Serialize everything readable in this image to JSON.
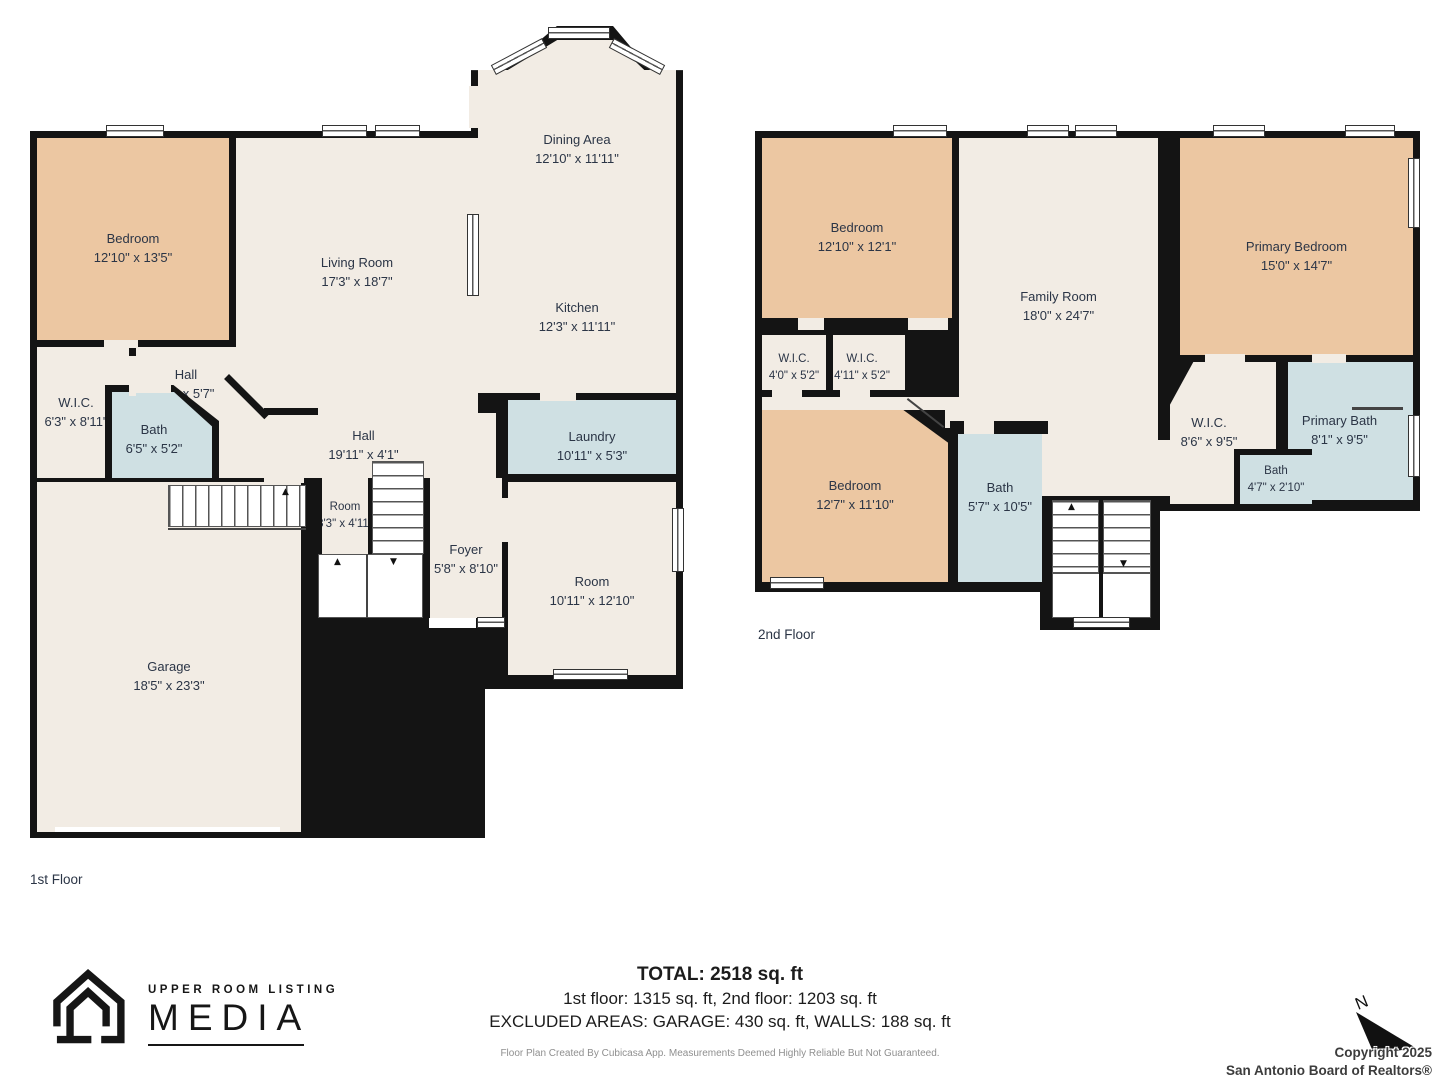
{
  "colors": {
    "wall": "#141414",
    "floor": "#f2ece4",
    "bedroom_fill": "#ecc7a2",
    "wet_room_fill": "#cfe0e3",
    "label_text": "#2b3546",
    "disclaimer_text": "#8f8f8f"
  },
  "floor1": {
    "label": "1st Floor",
    "rooms": {
      "bedroom": {
        "name": "Bedroom",
        "dims": "12'10\" x 13'5\""
      },
      "living": {
        "name": "Living Room",
        "dims": "17'3\" x 18'7\""
      },
      "dining": {
        "name": "Dining Area",
        "dims": "12'10\" x 11'11\""
      },
      "kitchen": {
        "name": "Kitchen",
        "dims": "12'3\" x 11'11\""
      },
      "hall_upper": {
        "name": "Hall",
        "dims": "6'9\" x 5'7\""
      },
      "wic": {
        "name": "W.I.C.",
        "dims": "6'3\" x 8'11\""
      },
      "bath": {
        "name": "Bath",
        "dims": "6'5\" x 5'2\""
      },
      "hall": {
        "name": "Hall",
        "dims": "19'11\" x 4'1\""
      },
      "laundry": {
        "name": "Laundry",
        "dims": "10'11\" x 5'3\""
      },
      "room_small": {
        "name": "Room",
        "dims": "3'3\" x 4'11\""
      },
      "foyer": {
        "name": "Foyer",
        "dims": "5'8\" x 8'10\""
      },
      "room": {
        "name": "Room",
        "dims": "10'11\" x 12'10\""
      },
      "garage": {
        "name": "Garage",
        "dims": "18'5\" x 23'3\""
      }
    }
  },
  "floor2": {
    "label": "2nd Floor",
    "rooms": {
      "bedroom_top": {
        "name": "Bedroom",
        "dims": "12'10\" x 12'1\""
      },
      "family": {
        "name": "Family Room",
        "dims": "18'0\" x 24'7\""
      },
      "primary_bedroom": {
        "name": "Primary Bedroom",
        "dims": "15'0\" x 14'7\""
      },
      "wic_a": {
        "name": "W.I.C.",
        "dims": "4'0\" x 5'2\""
      },
      "wic_b": {
        "name": "W.I.C.",
        "dims": "4'11\" x 5'2\""
      },
      "bedroom_bottom": {
        "name": "Bedroom",
        "dims": "12'7\" x 11'10\""
      },
      "bath": {
        "name": "Bath",
        "dims": "5'7\" x 10'5\""
      },
      "wic_primary": {
        "name": "W.I.C.",
        "dims": "8'6\" x 9'5\""
      },
      "primary_bath": {
        "name": "Primary Bath",
        "dims": "8'1\" x 9'5\""
      },
      "bath_small": {
        "name": "Bath",
        "dims": "4'7\" x 2'10\""
      }
    }
  },
  "footer": {
    "total": "TOTAL: 2518 sq. ft",
    "floors_line": "1st floor: 1315 sq. ft, 2nd floor: 1203 sq. ft",
    "excluded_line": "EXCLUDED AREAS: GARAGE: 430 sq. ft, WALLS: 188 sq. ft",
    "disclaimer": "Floor Plan Created By Cubicasa App. Measurements Deemed Highly Reliable But Not Guaranteed."
  },
  "logo": {
    "line1": "UPPER ROOM LISTING",
    "line2": "MEDIA"
  },
  "copyright": {
    "line1": "Copyright 2025",
    "line2": "San Antonio Board of Realtors®"
  },
  "compass": {
    "label": "N"
  }
}
